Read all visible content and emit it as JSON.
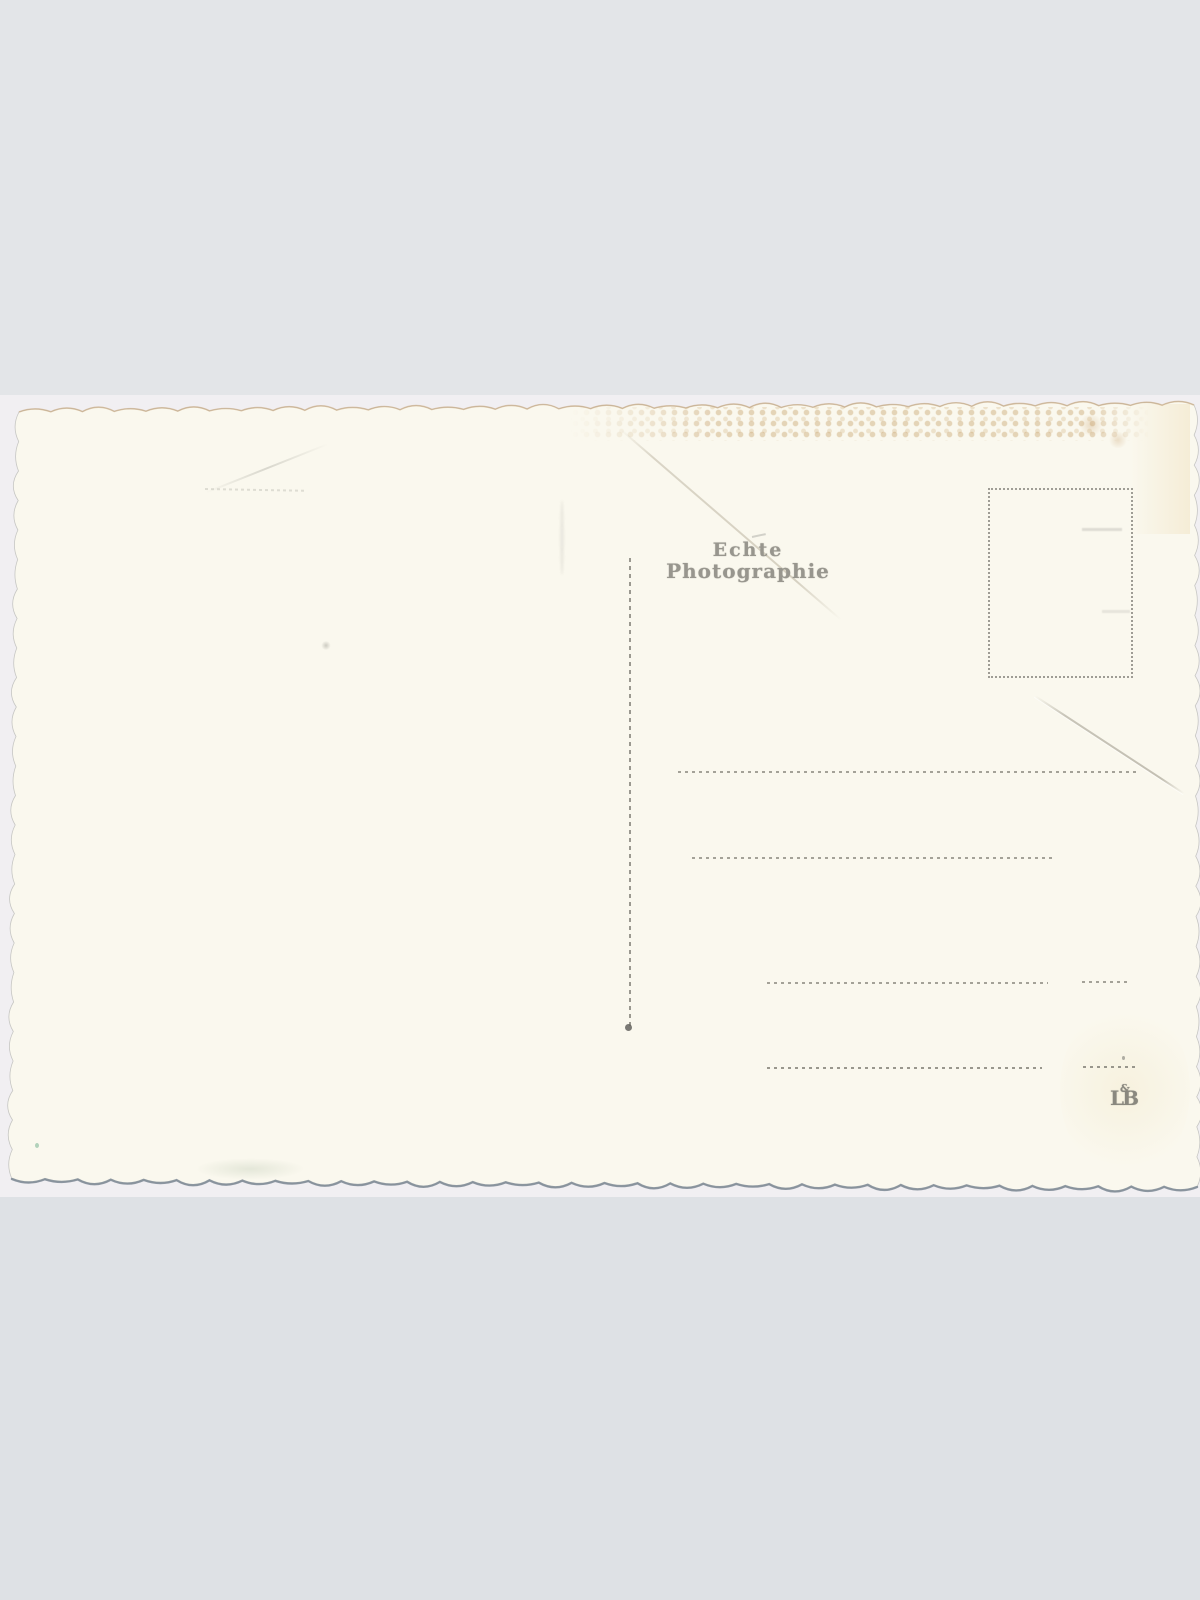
{
  "postcard": {
    "stamp": {
      "line1": "Echte",
      "line2": "Photographie"
    },
    "publisher_mark": {
      "left": "L",
      "ampersand": "&",
      "right": "B"
    },
    "colors": {
      "page_band_top": "#e3e5e8",
      "page_band_bottom": "#dee1e5",
      "scan_background": "#f1eff2",
      "card": "#faf8ee",
      "stamp_ink": "#98968e",
      "rule_ink": "#8e8c82",
      "bottom_edge_shadow": "#76828f",
      "deckle_stain": "#c8a36f"
    }
  }
}
